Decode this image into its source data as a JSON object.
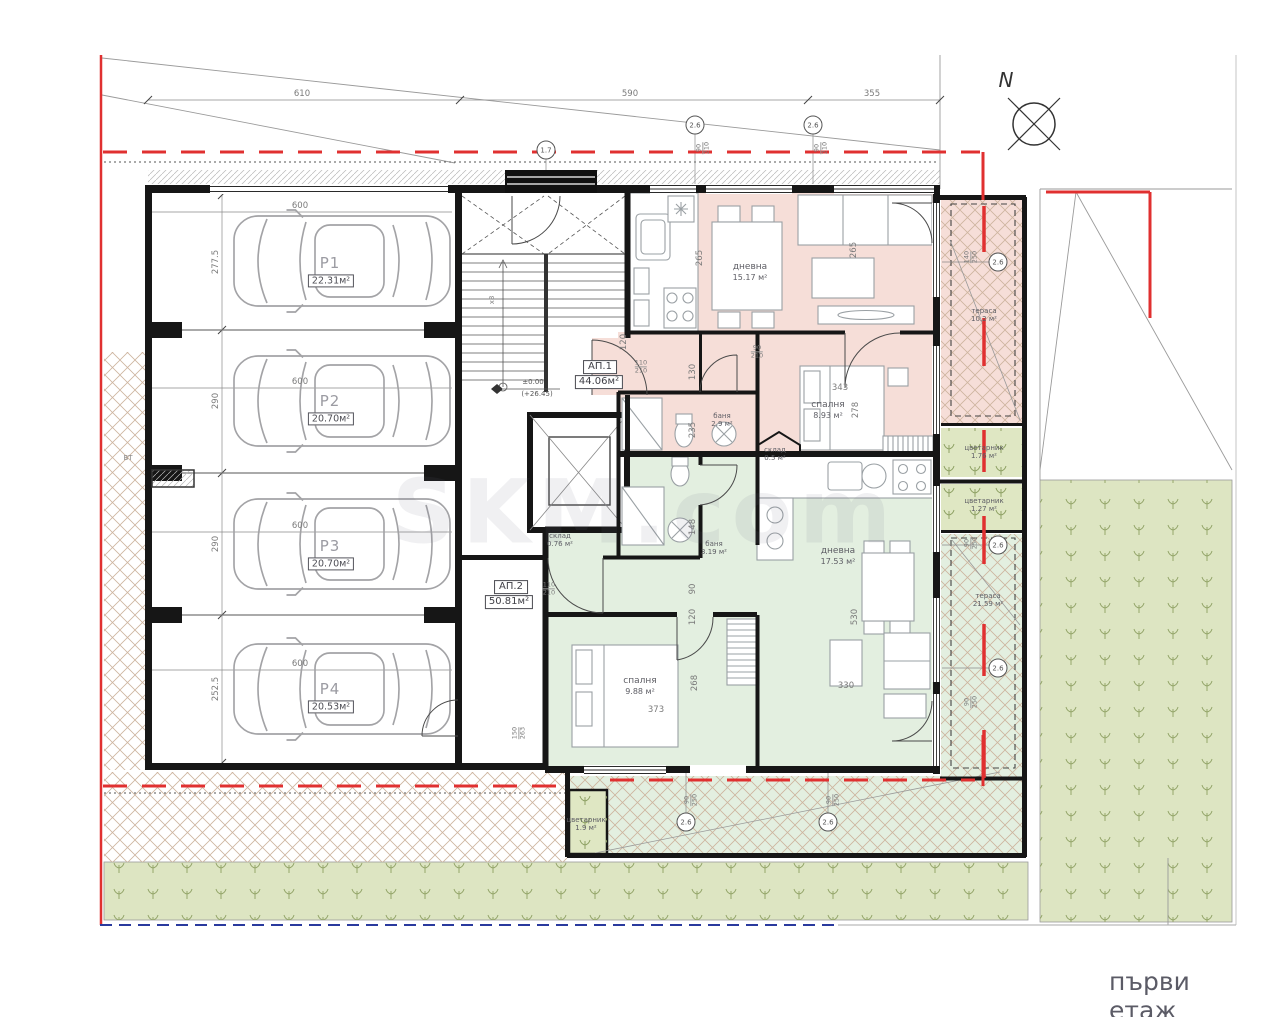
{
  "site": {
    "north_letter": "N",
    "floor_label": "първи етаж",
    "watermark": "SKM.com",
    "bt_label": "ВТ",
    "stairs_count": "x8",
    "elevation_top": "±0.00",
    "elevation_bottom": "(+26.45)"
  },
  "colors": {
    "boundary_red": "#e03030",
    "regulation_blue": "#2a3a9e",
    "ap1_fill": "#f6ded8",
    "ap2_fill": "#e3efe0",
    "grass_fill": "#dde5c2"
  },
  "dims_top": [
    "610",
    "590",
    "355"
  ],
  "parking": [
    {
      "id": "P1",
      "area": "22.31м²",
      "width": "277.5",
      "length": "600"
    },
    {
      "id": "P2",
      "area": "20.70м²",
      "width": "290",
      "length": "600"
    },
    {
      "id": "P3",
      "area": "20.70м²",
      "width": "290",
      "length": "600"
    },
    {
      "id": "P4",
      "area": "20.53м²",
      "width": "252.5",
      "length": "600"
    }
  ],
  "apartments": [
    {
      "id": "АП.1",
      "area": "44.06м²"
    },
    {
      "id": "АП.2",
      "area": "50.81м²"
    }
  ],
  "rooms": [
    {
      "name": "дневна",
      "area": "15.17 м²"
    },
    {
      "name": "спалня",
      "area": "8.93 м²"
    },
    {
      "name": "баня",
      "area": "2.9 м²"
    },
    {
      "name": "склад",
      "area": "0.5 м²"
    },
    {
      "name": "тераса",
      "area": "10.2 м²"
    },
    {
      "name": "склад",
      "area": "0.76 м²"
    },
    {
      "name": "баня",
      "area": "3.19 м²"
    },
    {
      "name": "спалня",
      "area": "9.88 м²"
    },
    {
      "name": "дневна",
      "area": "17.53 м²"
    },
    {
      "name": "тераса",
      "area": "21.59 м²"
    },
    {
      "name": "цветарник",
      "area": "1.76 м²"
    },
    {
      "name": "цветарник",
      "area": "1.27 м²"
    },
    {
      "name": "цветарник",
      "area": "1.9 м²"
    }
  ],
  "dims_inner": [
    "265",
    "265",
    "343",
    "278",
    "130",
    "120",
    "235",
    "148",
    "90",
    "120",
    "373",
    "268",
    "530",
    "330"
  ],
  "door_windows": [
    {
      "w": "90",
      "h": "210"
    },
    {
      "w": "90",
      "h": "210"
    },
    {
      "w": "110",
      "h": "210"
    },
    {
      "w": "110",
      "h": "210"
    },
    {
      "w": "90",
      "h": "210"
    },
    {
      "w": "140",
      "h": "250"
    },
    {
      "w": "90",
      "h": "250"
    },
    {
      "w": "90",
      "h": "250"
    },
    {
      "w": "150",
      "h": "263"
    },
    {
      "w": "90",
      "h": "250"
    },
    {
      "w": "90",
      "h": "250"
    }
  ],
  "markers": [
    "2.6",
    "2.6",
    "1.7",
    "2.6",
    "2.6",
    "2.6",
    "2.6",
    "2.6"
  ]
}
